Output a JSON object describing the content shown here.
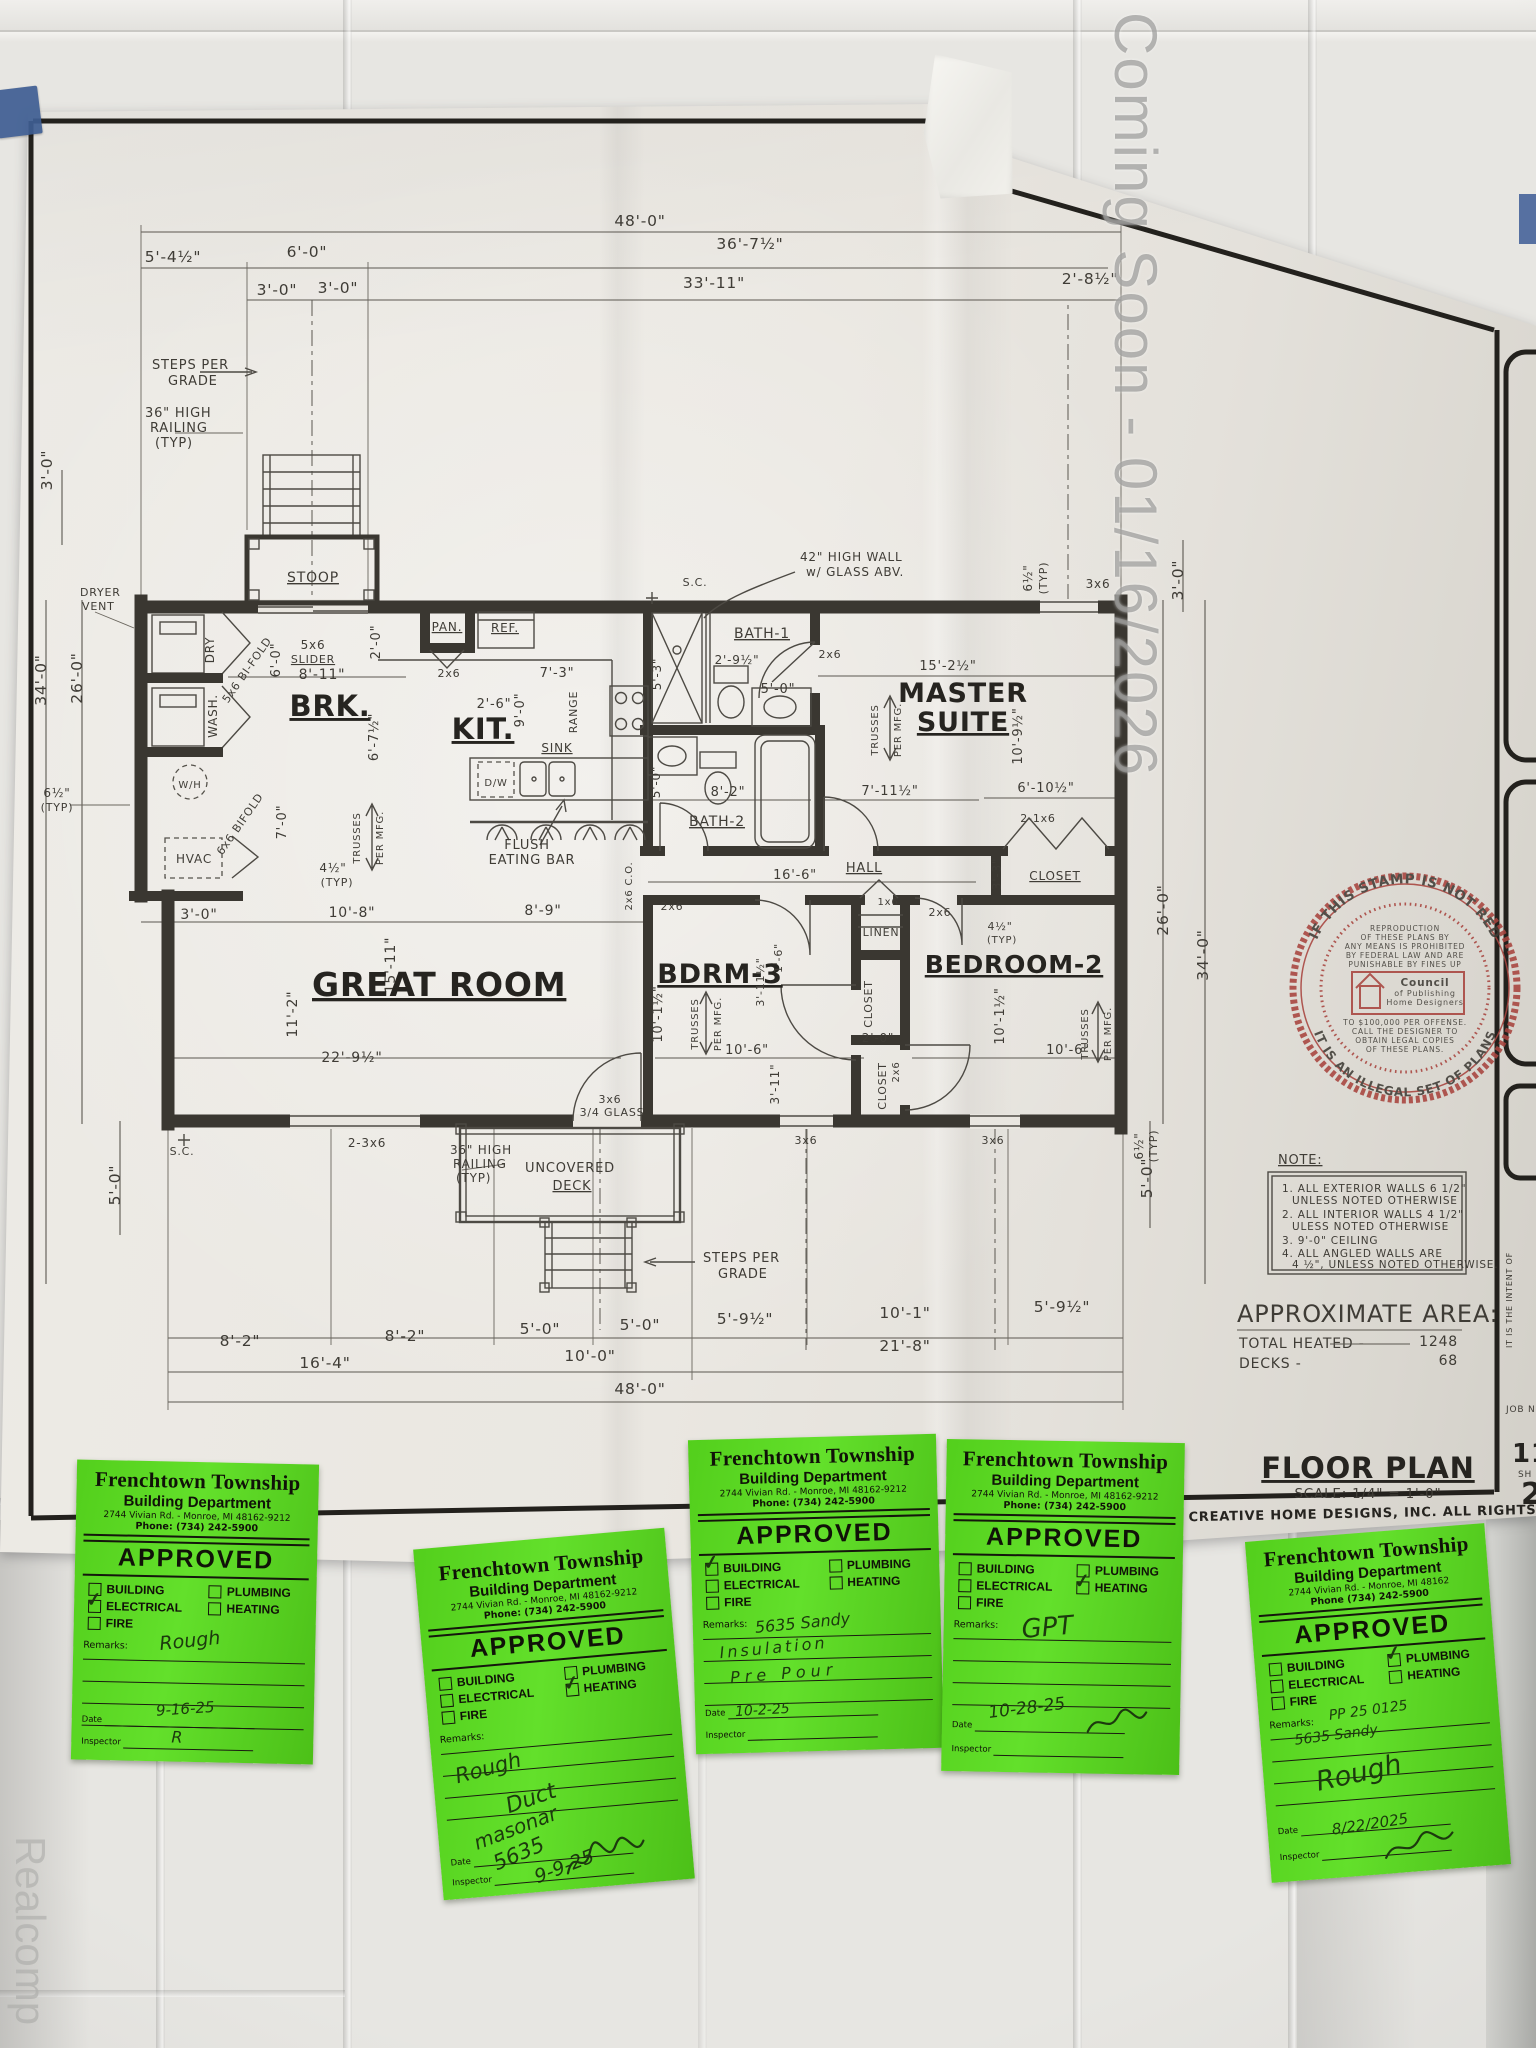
{
  "watermarks": {
    "coming_soon": "Coming Soon - 01/16/2026",
    "realcomp": "Realcomp"
  },
  "sheet": {
    "rooms": {
      "brk": "BRK.",
      "kit": "KIT.",
      "great": "GREAT ROOM",
      "master1": "MASTER",
      "master2": "SUITE",
      "bdrm3": "BDRM-3",
      "bedroom2": "BEDROOM-2",
      "bath1": "BATH-1",
      "bath2": "BATH-2",
      "hall": "HALL",
      "linen": "LINEN",
      "closet": "CLOSET",
      "stoop": "STOOP",
      "deck1": "UNCOVERED",
      "deck2": "DECK",
      "pan": "PAN.",
      "ref": "REF.",
      "range": "RANGE",
      "sink": "SINK",
      "dw": "D/W",
      "wh": "W/H",
      "hvac": "HVAC",
      "dry": "DRY",
      "wash": "WASH.",
      "sc": "S.C."
    },
    "ann": {
      "steps1": "STEPS PER",
      "steps2": "GRADE",
      "rail1": "36\" HIGH",
      "rail2": "RAILING",
      "rail3": "(TYP)",
      "dryv1": "DRYER",
      "dryv2": "VENT",
      "hw1": "42\" HIGH WALL",
      "hw2": "w/ GLASS ABV.",
      "slider": "SLIDER",
      "bifold56": "5x6 BI-FOLD",
      "bifold66": "6x6 BIFOLD",
      "flush1": "FLUSH",
      "flush2": "EATING BAR",
      "tr1": "TRUSSES",
      "tr2": "PER MFG.",
      "glass": "3/4 GLASS"
    },
    "d": {
      "a48": "48'-0\"",
      "a5_4h": "5'-4½\"",
      "a6_0": "6'-0\"",
      "a36_7h": "36'-7½\"",
      "a3_0": "3'-0\"",
      "a33_11": "33'-11\"",
      "a2_8h": "2'-8½\"",
      "a34_0": "34'-0\"",
      "a26_0": "26'-0\"",
      "a6h": "6½\"",
      "typ": "(TYP)",
      "a5_0": "5'-0\"",
      "a8_2": "8'-2\"",
      "a5_9h": "5'-9½\"",
      "a10_1": "10'-1\"",
      "a21_8": "21'-8\"",
      "a16_4": "16'-4\"",
      "a10_0": "10'-0\"",
      "a8_11": "8'-11\"",
      "a2_0": "2'-0\"",
      "a2_6": "2'-6\"",
      "a7_3": "7'-3\"",
      "a9_0": "9'-0\"",
      "a7_0": "7'-0\"",
      "a10_8": "10'-8\"",
      "a8_9": "8'-9\"",
      "a15_11": "15'-11\"",
      "a11_2": "11'-2\"",
      "a22_9h": "22'-9½\"",
      "a4h": "4½\"",
      "a6_7h": "6'-7½\"",
      "a2_9h": "2'-9½\"",
      "a5_3": "5'-3\"",
      "a15_2h": "15'-2½\"",
      "a10_9h": "10'-9½\"",
      "a6_10h": "6'-10½\"",
      "a7_11h": "7'-11½\"",
      "a16_6": "16'-6\"",
      "a3_3": "3'-3\"",
      "a10_1h": "10'-1½\"",
      "a3_11h": "3'-11½\"",
      "a1_6": "1'-6\"",
      "a3_11": "3'-11\"",
      "a10_6": "10'-6\"",
      "x2x6": "2x6",
      "x1x6": "1x6",
      "x3x6": "3x6",
      "x5x6": "5x6",
      "x2_3x6": "2-3x6",
      "x2_1x6": "2-1x6",
      "co": "2x6 C.O."
    },
    "notes": {
      "title": "NOTE:",
      "lines": [
        "1. ALL EXTERIOR WALLS 6 1/2\"",
        "UNLESS NOTED OTHERWISE",
        "2. ALL INTERIOR WALLS 4 1/2\"",
        "ULESS NOTED OTHERWISE",
        "3. 9'-0\" CEILING",
        "4. ALL ANGLED WALLS ARE",
        "4 ½\", UNLESS NOTED OTHERWISE."
      ]
    },
    "area": {
      "title": "APPROXIMATE AREA:",
      "heated_label": "TOTAL HEATED -",
      "heated_value": "1248",
      "decks_label": "DECKS -",
      "decks_value": "68"
    },
    "titleblock": {
      "title": "FLOOR PLAN",
      "scale": "SCALE: 1/4\" = 1'-0\"",
      "copyright": ", BY CREATIVE HOME DESIGNS, INC. ALL RIGHTS RESERVED",
      "frag_sheet": "11-",
      "frag_sh": "SH",
      "frag_num": "2",
      "frag_job": "JOB N",
      "frag_intent": "IT IS THE INTENT OF"
    },
    "stamp": {
      "arc_top": "IF THIS STAMP IS NOT RED",
      "arc_bottom": "IT IS AN ILLEGAL SET OF PLANS",
      "lines": [
        "REPRODUCTION",
        "OF THESE PLANS BY",
        "ANY MEANS IS PROHIBITED",
        "BY FEDERAL LAW AND ARE",
        "PUNISHABLE BY FINES UP"
      ],
      "org": [
        "Council",
        "of Publishing",
        "Home Designers"
      ],
      "lines2": [
        "TO $100,000 PER OFFENSE.",
        "CALL THE DESIGNER TO",
        "OBTAIN LEGAL COPIES",
        "OF THESE PLANS."
      ]
    }
  },
  "stickers": {
    "township": "Frenchtown Township",
    "dept": "Building Department",
    "approved": "APPROVED",
    "check_labels": [
      "BUILDING",
      "PLUMBING",
      "ELECTRICAL",
      "HEATING",
      "FIRE"
    ],
    "remarks_label": "Remarks:",
    "date_label": "Date",
    "inspector_label": "Inspector",
    "check_glyph": "✓",
    "items": [
      {
        "address": "2744 Vivian Rd. - Monroe, MI 48162-9212",
        "phone": "Phone: (734) 242-5900",
        "checked": "ELECTRICAL",
        "remark": "Rough",
        "date": "9-16-25",
        "inspector": "R"
      },
      {
        "address": "2744 Vivian Rd. - Monroe, MI 48162-9212",
        "phone": "Phone: (734) 242-5900",
        "checked": "HEATING",
        "remark": "Rough",
        "remark2": "Duct",
        "remark3": "masonar",
        "remark4": "5635",
        "date": "9-9-25"
      },
      {
        "address": "2744 Vivian Rd. - Monroe, MI 48162-9212",
        "phone": "Phone: (734) 242-5900",
        "checked": "BUILDING",
        "remark": "5635 Sandy",
        "remark2": "Insulation",
        "remark3": "Pre Pour",
        "date": "10-2-25"
      },
      {
        "address": "2744 Vivian Rd. - Monroe, MI 48162-9212",
        "phone": "Phone: (734) 242-5900",
        "checked": "HEATING",
        "remark": "GPT",
        "date": "10-28-25"
      },
      {
        "address": "2744 Vivian Rd. - Monroe, MI 48162",
        "phone": "Phone (734) 242-5900",
        "checked": "PLUMBING",
        "remark": "PP 25 0125",
        "remark2": "5635 Sandy",
        "remark3": "Rough",
        "date": "8/22/2025"
      }
    ]
  }
}
